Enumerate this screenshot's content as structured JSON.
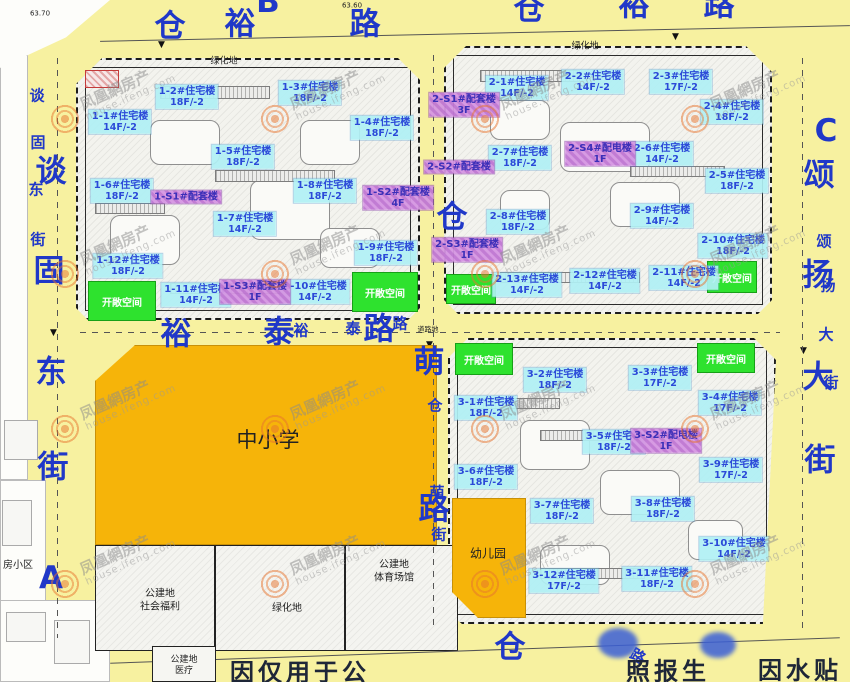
{
  "strings": {
    "open_space": "开敞空间"
  },
  "watermark": {
    "cn": "凤凰網房产",
    "en": "house.ifeng.com"
  },
  "colors": {
    "road_yellow": "#F7F1A0",
    "area_orange": "#F6B409",
    "open_space_green": "#2EE22E",
    "residential_label_bg": "#B0F0F4",
    "service_label_bg": "#D596E2",
    "label_text_blue": "#2B49D8",
    "road_text_blue": "#2038C8",
    "watermark_orange": "#E8742F"
  },
  "roads": {
    "top": "仓裕路",
    "left": "谈固东街",
    "right": "颂扬大街",
    "middle_horizontal": "裕泰路",
    "middle_vertical": "仓萌路",
    "bottom": "仓路"
  },
  "road_chars": [
    {
      "t": "仓",
      "x": 170,
      "y": 23,
      "k": "big"
    },
    {
      "t": "裕",
      "x": 240,
      "y": 21,
      "k": "big"
    },
    {
      "t": "路",
      "x": 365,
      "y": 21,
      "k": "big"
    },
    {
      "t": "B",
      "x": 268,
      "y": 2,
      "k": "big"
    },
    {
      "t": "仓",
      "x": 529,
      "y": 6,
      "k": "big"
    },
    {
      "t": "裕",
      "x": 634,
      "y": 2,
      "k": "big"
    },
    {
      "t": "路",
      "x": 719,
      "y": 2,
      "k": "big"
    },
    {
      "t": "谈",
      "x": 51,
      "y": 168,
      "k": "big"
    },
    {
      "t": "固",
      "x": 49,
      "y": 268,
      "k": "big"
    },
    {
      "t": "东",
      "x": 51,
      "y": 369,
      "k": "big"
    },
    {
      "t": "街",
      "x": 53,
      "y": 464,
      "k": "big"
    },
    {
      "t": "谈",
      "x": 37,
      "y": 95,
      "k": "small"
    },
    {
      "t": "固",
      "x": 38,
      "y": 142,
      "k": "small"
    },
    {
      "t": "东",
      "x": 36,
      "y": 189,
      "k": "small"
    },
    {
      "t": "街",
      "x": 38,
      "y": 239,
      "k": "small"
    },
    {
      "t": "A",
      "x": 51,
      "y": 578,
      "k": "big"
    },
    {
      "t": "C",
      "x": 826,
      "y": 131,
      "k": "big"
    },
    {
      "t": "颂",
      "x": 819,
      "y": 172,
      "k": "big"
    },
    {
      "t": "扬",
      "x": 818,
      "y": 272,
      "k": "big"
    },
    {
      "t": "大",
      "x": 818,
      "y": 374,
      "k": "big"
    },
    {
      "t": "街",
      "x": 820,
      "y": 457,
      "k": "big"
    },
    {
      "t": "颂",
      "x": 824,
      "y": 241,
      "k": "small"
    },
    {
      "t": "扬",
      "x": 828,
      "y": 285,
      "k": "small"
    },
    {
      "t": "大",
      "x": 826,
      "y": 334,
      "k": "small"
    },
    {
      "t": "街",
      "x": 831,
      "y": 382,
      "k": "small"
    },
    {
      "t": "裕",
      "x": 176,
      "y": 331,
      "k": "big"
    },
    {
      "t": "泰",
      "x": 279,
      "y": 329,
      "k": "big"
    },
    {
      "t": "路",
      "x": 379,
      "y": 326,
      "k": "big"
    },
    {
      "t": "裕",
      "x": 301,
      "y": 330,
      "k": "small"
    },
    {
      "t": "泰",
      "x": 353,
      "y": 328,
      "k": "small"
    },
    {
      "t": "路",
      "x": 400,
      "y": 323,
      "k": "small"
    },
    {
      "t": "仓",
      "x": 452,
      "y": 214,
      "k": "big"
    },
    {
      "t": "萌",
      "x": 429,
      "y": 359,
      "k": "big"
    },
    {
      "t": "路",
      "x": 434,
      "y": 506,
      "k": "big"
    },
    {
      "t": "仓",
      "x": 435,
      "y": 405,
      "k": "small"
    },
    {
      "t": "萌",
      "x": 437,
      "y": 492,
      "k": "small"
    },
    {
      "t": "街",
      "x": 439,
      "y": 534,
      "k": "small"
    },
    {
      "t": "仓",
      "x": 510,
      "y": 644,
      "k": "big"
    },
    {
      "t": "路",
      "x": 638,
      "y": 656,
      "k": "small",
      "rot": 30
    }
  ],
  "buildings": [
    {
      "name": "1-1#住宅楼",
      "floors": "14F/-2",
      "x": 120,
      "y": 122
    },
    {
      "name": "1-2#住宅楼",
      "floors": "18F/-2",
      "x": 187,
      "y": 97
    },
    {
      "name": "1-3#住宅楼",
      "floors": "18F/-2",
      "x": 310,
      "y": 93
    },
    {
      "name": "1-4#住宅楼",
      "floors": "18F/-2",
      "x": 382,
      "y": 128
    },
    {
      "name": "1-5#住宅楼",
      "floors": "18F/-2",
      "x": 243,
      "y": 157
    },
    {
      "name": "1-6#住宅楼",
      "floors": "18F/-2",
      "x": 122,
      "y": 191
    },
    {
      "name": "1-7#住宅楼",
      "floors": "14F/-2",
      "x": 245,
      "y": 224
    },
    {
      "name": "1-8#住宅楼",
      "floors": "18F/-2",
      "x": 325,
      "y": 191
    },
    {
      "name": "1-9#住宅楼",
      "floors": "18F/-2",
      "x": 386,
      "y": 253
    },
    {
      "name": "1-10#住宅楼",
      "floors": "14F/-2",
      "x": 315,
      "y": 292
    },
    {
      "name": "1-11#住宅楼",
      "floors": "14F/-2",
      "x": 196,
      "y": 295
    },
    {
      "name": "1-12#住宅楼",
      "floors": "18F/-2",
      "x": 128,
      "y": 266
    },
    {
      "name": "1-S1#配套楼",
      "floors": "",
      "x": 186,
      "y": 197,
      "k": "svc"
    },
    {
      "name": "1-S2#配套楼",
      "floors": "4F",
      "x": 398,
      "y": 198,
      "k": "svc"
    },
    {
      "name": "1-S3#配套楼",
      "floors": "1F",
      "x": 255,
      "y": 292,
      "k": "svc"
    },
    {
      "name": "2-1#住宅楼",
      "floors": "14F/-2",
      "x": 517,
      "y": 88
    },
    {
      "name": "2-2#住宅楼",
      "floors": "14F/-2",
      "x": 593,
      "y": 82
    },
    {
      "name": "2-3#住宅楼",
      "floors": "17F/-2",
      "x": 681,
      "y": 82
    },
    {
      "name": "2-4#住宅楼",
      "floors": "18F/-2",
      "x": 732,
      "y": 112
    },
    {
      "name": "2-5#住宅楼",
      "floors": "18F/-2",
      "x": 737,
      "y": 181
    },
    {
      "name": "2-6#住宅楼",
      "floors": "14F/-2",
      "x": 662,
      "y": 154
    },
    {
      "name": "2-7#住宅楼",
      "floors": "18F/-2",
      "x": 520,
      "y": 158
    },
    {
      "name": "2-8#住宅楼",
      "floors": "18F/-2",
      "x": 518,
      "y": 222
    },
    {
      "name": "2-9#住宅楼",
      "floors": "14F/-2",
      "x": 662,
      "y": 216
    },
    {
      "name": "2-10#住宅楼",
      "floors": "18F/-2",
      "x": 733,
      "y": 246
    },
    {
      "name": "2-11#住宅楼",
      "floors": "14F/-2",
      "x": 684,
      "y": 278
    },
    {
      "name": "2-12#住宅楼",
      "floors": "14F/-2",
      "x": 605,
      "y": 281
    },
    {
      "name": "2-13#住宅楼",
      "floors": "14F/-2",
      "x": 527,
      "y": 285
    },
    {
      "name": "2-S1#配套楼",
      "floors": "3F",
      "x": 464,
      "y": 105,
      "k": "svc"
    },
    {
      "name": "2-S2#配套楼",
      "floors": "",
      "x": 459,
      "y": 167,
      "k": "svc"
    },
    {
      "name": "2-S3#配套楼",
      "floors": "1F",
      "x": 467,
      "y": 250,
      "k": "svc"
    },
    {
      "name": "2-S4#配电楼",
      "floors": "1F",
      "x": 600,
      "y": 154,
      "k": "svc"
    },
    {
      "name": "3-1#住宅楼",
      "floors": "18F/-2",
      "x": 486,
      "y": 408
    },
    {
      "name": "3-2#住宅楼",
      "floors": "18F/-2",
      "x": 555,
      "y": 380
    },
    {
      "name": "3-3#住宅楼",
      "floors": "17F/-2",
      "x": 660,
      "y": 378
    },
    {
      "name": "3-4#住宅楼",
      "floors": "17F/-2",
      "x": 730,
      "y": 403
    },
    {
      "name": "3-5#住宅楼",
      "floors": "18F/-2",
      "x": 614,
      "y": 442
    },
    {
      "name": "3-6#住宅楼",
      "floors": "18F/-2",
      "x": 486,
      "y": 477
    },
    {
      "name": "3-7#住宅楼",
      "floors": "18F/-2",
      "x": 562,
      "y": 511
    },
    {
      "name": "3-8#住宅楼",
      "floors": "18F/-2",
      "x": 663,
      "y": 509
    },
    {
      "name": "3-9#住宅楼",
      "floors": "17F/-2",
      "x": 731,
      "y": 470
    },
    {
      "name": "3-10#住宅楼",
      "floors": "14F/-2",
      "x": 734,
      "y": 549
    },
    {
      "name": "3-11#住宅楼",
      "floors": "18F/-2",
      "x": 657,
      "y": 579
    },
    {
      "name": "3-12#住宅楼",
      "floors": "17F/-2",
      "x": 564,
      "y": 581
    },
    {
      "name": "3-S2#配电楼",
      "floors": "1F",
      "x": 666,
      "y": 441,
      "k": "svc"
    }
  ],
  "open_spaces": [
    {
      "x": 122,
      "y": 301,
      "w": 68,
      "h": 40
    },
    {
      "x": 385,
      "y": 292,
      "w": 66,
      "h": 40
    },
    {
      "x": 471,
      "y": 289,
      "w": 50,
      "h": 30
    },
    {
      "x": 732,
      "y": 277,
      "w": 50,
      "h": 32
    },
    {
      "x": 484,
      "y": 359,
      "w": 58,
      "h": 32
    },
    {
      "x": 726,
      "y": 358,
      "w": 58,
      "h": 30
    }
  ],
  "land_labels": [
    {
      "t": "绿化地",
      "x": 224,
      "y": 62,
      "s": 9
    },
    {
      "t": "绿化地",
      "x": 585,
      "y": 47,
      "s": 9
    },
    {
      "t": "中小学",
      "x": 268,
      "y": 440,
      "s": 21
    },
    {
      "t": "幼儿园",
      "x": 488,
      "y": 554,
      "s": 12
    },
    {
      "t": "公建地\n社会福利",
      "x": 160,
      "y": 601,
      "s": 10
    },
    {
      "t": "绿化地",
      "x": 287,
      "y": 609,
      "s": 10
    },
    {
      "t": "公建地\n体育场馆",
      "x": 394,
      "y": 572,
      "s": 10
    },
    {
      "t": "公建地\n医疗",
      "x": 184,
      "y": 666,
      "s": 9
    },
    {
      "t": "房小区",
      "x": 18,
      "y": 566,
      "s": 10
    },
    {
      "t": "道路地",
      "x": 428,
      "y": 330,
      "s": 7
    },
    {
      "t": "63.70",
      "x": 40,
      "y": 14,
      "s": 7
    },
    {
      "t": "63.60",
      "x": 352,
      "y": 6,
      "s": 7
    }
  ],
  "disclaimer": [
    {
      "t": "因仅用于公",
      "x": 300,
      "y": 670
    },
    {
      "t": "照报生",
      "x": 668,
      "y": 669
    },
    {
      "t": "因水贴",
      "x": 800,
      "y": 668
    }
  ]
}
